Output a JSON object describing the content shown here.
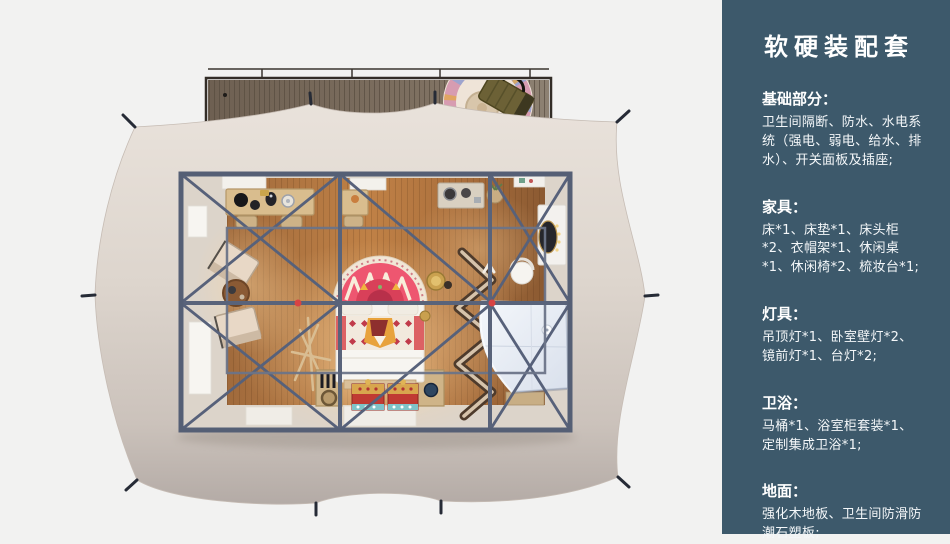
{
  "sidebar": {
    "title": "软硬装配套",
    "sections": [
      {
        "heading": "基础部分：",
        "body": "卫生间隔断、防水、水电系统（强电、弱电、给水、排水）、开关面板及插座;"
      },
      {
        "heading": "家具：",
        "body": "床*1、床垫*1、床头柜*2、衣帽架*1、休闲桌*1、休闲椅*2、梳妆台*1;"
      },
      {
        "heading": "灯具：",
        "body": "吊顶灯*1、卧室壁灯*2、镜前灯*1、台灯*2;"
      },
      {
        "heading": "卫浴：",
        "body": "马桶*1、浴室柜套装*1、定制集成卫浴*1;"
      },
      {
        "heading": "地面：",
        "body": "强化木地板、卫生间防滑防潮石塑板;"
      }
    ],
    "colors": {
      "background": "#3d596b",
      "text": "#ffffff"
    }
  },
  "floorplan": {
    "type": "top-view-3d-render",
    "elements": [
      "tent-canvas",
      "guy-line-stakes",
      "wood-deck",
      "deck-rug",
      "picnic-basket",
      "steel-frame",
      "ridge-joints",
      "wood-floor",
      "writing-desk",
      "desk-chairs",
      "lounge-chairs",
      "leisure-table",
      "mandala-rug",
      "bed",
      "pattern-blanket",
      "storage-chests",
      "wine-crate",
      "nightstand-bench",
      "coat-rack",
      "zigzag-rack",
      "kitchen-counter",
      "plant-basket",
      "vanity-table",
      "vanity-mirror",
      "vanity-chair",
      "integrated-bathroom"
    ],
    "colors": {
      "background": "#f2f2f1",
      "tent_canvas": "#e3dcd4",
      "deck_wood": "#77695a",
      "floor_wood": "#b5763f",
      "frame": "#59637a",
      "joint_accent": "#d84343",
      "bed": "#f6f3ee",
      "chest_red": "#c03a33",
      "bathroom": "#e9eef6"
    }
  }
}
